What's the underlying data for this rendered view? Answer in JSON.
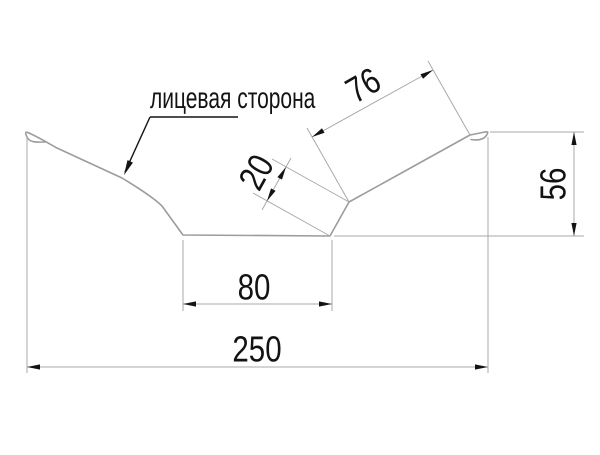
{
  "drawing": {
    "callout_label": "лицевая сторона",
    "dimensions": {
      "wing_length": "76",
      "flange_width": "20",
      "right_height": "56",
      "bottom_width": "80",
      "overall_width": "250"
    },
    "colors": {
      "background": "#ffffff",
      "profile_line": "#9c9c9c",
      "dim_line": "#a9a9a9",
      "annotation": "#131313"
    }
  }
}
